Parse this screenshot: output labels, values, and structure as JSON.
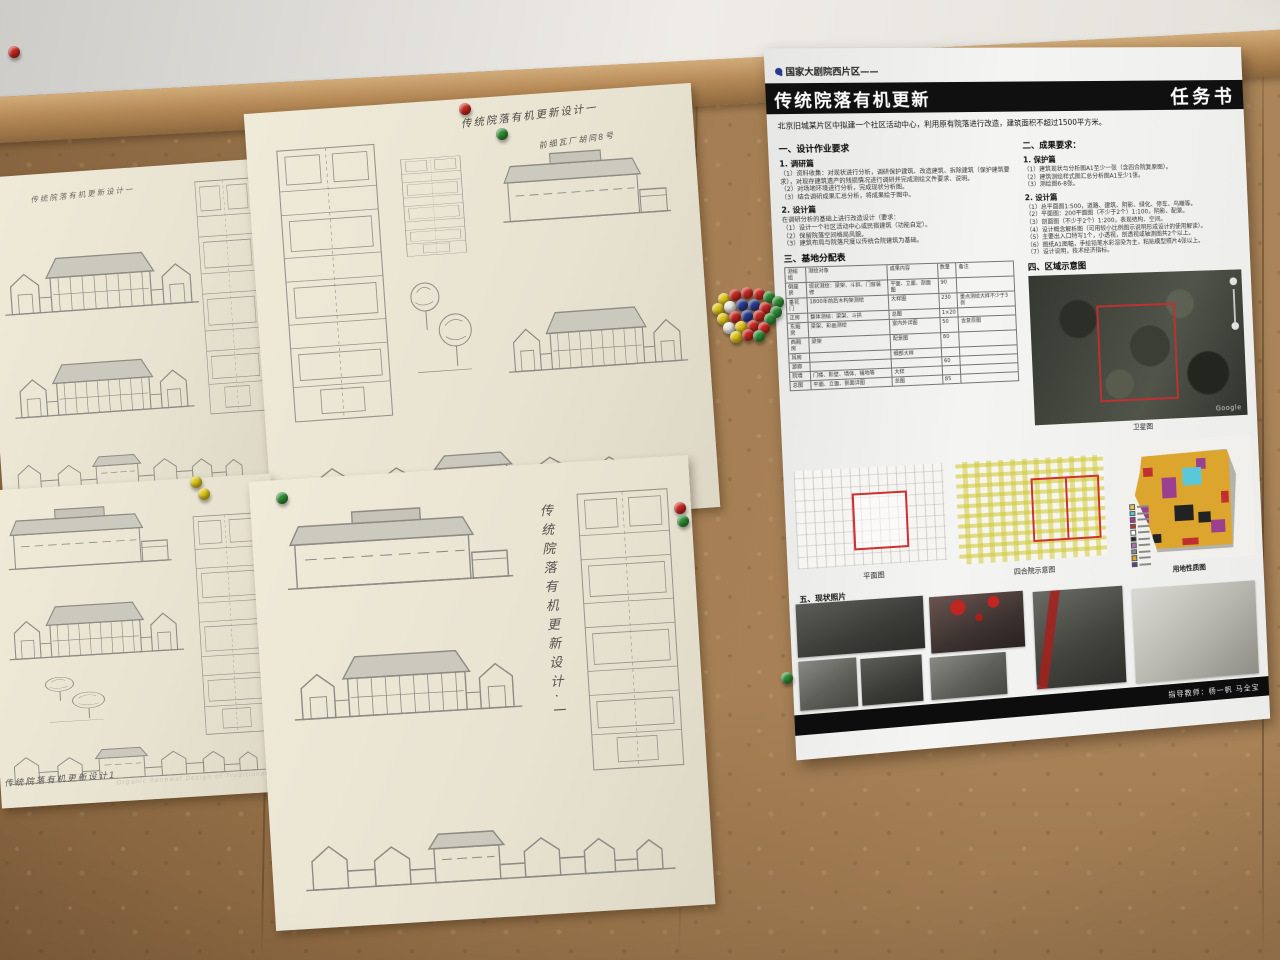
{
  "poster": {
    "corner_tag": "任务书",
    "project_tag": "国家大剧院西片区——",
    "title": "传统院落有机更新",
    "subtitle": "北京旧城某片区中拟建一个社区活动中心，利用原有院落进行改造，建筑面积不超过1500平方米。",
    "left_col": {
      "h1": "一、设计作业要求",
      "s1_h": "1. 调研篇",
      "s1_lines": [
        "（1）资料收集：对现状进行分析，调研保护建筑、改造建筑、拆除建筑（保护建筑要求），对现存建筑遗产的残损情况进行调研并完成测绘文件要求、说明。",
        "（2）对场地环境进行分析，完成现状分析图。",
        "（3）结合调研成果汇总分析，将成果绘于图中。"
      ],
      "s2_h": "2. 设计篇",
      "s2_lines": [
        "在调研分析的基础上进行改造设计（要求：",
        "（1）设计一个社区活动中心或民宿建筑（功能自定）。",
        "（2）保留院落空间格局风貌。",
        "（3）建筑布局与院落尺度以传统合院建筑为基础。"
      ],
      "h3": "三、基地分配表"
    },
    "table": {
      "headers": [
        "测绘组",
        "测绘对象",
        "成果内容",
        "数量",
        "备注"
      ],
      "rows": [
        [
          "倒座房",
          "现状测绘：梁架、斗拱、门窗装修",
          "平面、立面、剖面图",
          "90",
          ""
        ],
        [
          "垂花门",
          "1800年前后木构架测绘",
          "大样图",
          "230",
          "重点测绘大样不少于3张"
        ],
        [
          "正房",
          "整体测绘：梁架、斗拱",
          "总图",
          "1×20",
          ""
        ],
        [
          "东厢房",
          "梁架、彩画测绘",
          "室内外详图",
          "50",
          "含复原图"
        ],
        [
          "西厢房",
          "梁架",
          "配景图",
          "80",
          ""
        ],
        [
          "耳房",
          "",
          "细部大样",
          "",
          ""
        ],
        [
          "游廊",
          "",
          "",
          "60",
          ""
        ],
        [
          "院墙",
          "门楼、影壁、墙体、铺地等",
          "大样",
          "",
          ""
        ],
        [
          "总图",
          "平面、立面、剖面详图",
          "总图",
          "85",
          ""
        ]
      ]
    },
    "right_col": {
      "h2": "二、成果要求：",
      "p1_h": "1. 保护篇",
      "p1_lines": [
        "（1）建筑现状与分析图A1至少一张（含四合院复原图）。",
        "（2）建筑测绘样式图汇总分析图A1至少1张。",
        "（3）测绘图6-8张。"
      ],
      "p2_h": "2. 设计篇",
      "p2_lines": [
        "（1）总平面图1:500，道路、建筑、阴影、绿化、停车、鸟瞰等。",
        "（2）平面图：200平面图（不少于2个）1:100，阴影、配景。",
        "（3）剖面图（不少于2个）1:200，表现结构、空间。",
        "（4）设计概念解析图（可用较小比例图示说明形成设计的使用解读）。",
        "（5）主要出入口特写1个，小透视，剖透视或轴测图共2个以上。",
        "（6）图纸A1图幅，手绘铅笔水彩渲染为主，粘贴模型照片4张以上。",
        "（7）设计说明，技术经济指标。"
      ],
      "h4": "四、区域示意图"
    },
    "satellite": {
      "caption": "卫星图",
      "watermark": "Google"
    },
    "maps": {
      "m1_caption": "平面图",
      "m2_caption": "四合院示意图",
      "m3_caption": "用地性质图"
    },
    "photos_heading": "五、现状照片",
    "footer": "指导教师：杨一帆  马全宝",
    "landuse_legend": [
      "#e2c84a",
      "#59c8d8",
      "#9b3f8f",
      "#c03030",
      "#ffffff",
      "#222222",
      "#b06fae",
      "#8a8a8a",
      "#d9a62e",
      "#5a3f8f"
    ]
  },
  "sheets": {
    "a": {
      "title": "传统院落有机更新设计一"
    },
    "b": {
      "title": "传统院落有机更新设计一",
      "subtitle": "前细瓦厂胡同8号"
    },
    "c": {
      "title": "传统院落有机更新设计1",
      "subtitle_en": "Organic Renewal Design of Traditional Courtyard"
    },
    "d": {
      "title_vertical": "传统院落有机更新设计·一"
    }
  },
  "drawings": {
    "a": [
      {
        "type": "court",
        "x": 12,
        "y": 62,
        "w": 200,
        "h": 85
      },
      {
        "type": "court",
        "x": 15,
        "y": 170,
        "w": 185,
        "h": 80
      },
      {
        "type": "street",
        "x": 10,
        "y": 268,
        "w": 240,
        "h": 55
      },
      {
        "type": "plan",
        "x": 210,
        "y": 15,
        "w": 62,
        "h": 240
      }
    ],
    "b": [
      {
        "type": "plan",
        "x": 25,
        "y": 35,
        "w": 108,
        "h": 280
      },
      {
        "type": "plan",
        "x": 150,
        "y": 55,
        "w": 66,
        "h": 100
      },
      {
        "type": "trees",
        "x": 148,
        "y": 170,
        "w": 70,
        "h": 120
      },
      {
        "type": "long",
        "x": 248,
        "y": 55,
        "w": 175,
        "h": 80
      },
      {
        "type": "court",
        "x": 244,
        "y": 195,
        "w": 185,
        "h": 90
      },
      {
        "type": "street",
        "x": 35,
        "y": 330,
        "w": 385,
        "h": 75
      }
    ],
    "c": [
      {
        "type": "long",
        "x": 18,
        "y": 18,
        "w": 170,
        "h": 70
      },
      {
        "type": "court",
        "x": 14,
        "y": 98,
        "w": 180,
        "h": 80
      },
      {
        "type": "trees",
        "x": 45,
        "y": 185,
        "w": 70,
        "h": 60
      },
      {
        "type": "plan",
        "x": 205,
        "y": 35,
        "w": 70,
        "h": 225
      },
      {
        "type": "street",
        "x": 8,
        "y": 248,
        "w": 260,
        "h": 52
      }
    ],
    "d": [
      {
        "type": "long",
        "x": 28,
        "y": 30,
        "w": 235,
        "h": 90
      },
      {
        "type": "court",
        "x": 28,
        "y": 155,
        "w": 235,
        "h": 95
      },
      {
        "type": "plan",
        "x": 322,
        "y": 28,
        "w": 100,
        "h": 285
      },
      {
        "type": "street",
        "x": 30,
        "y": 335,
        "w": 375,
        "h": 85
      }
    ]
  },
  "photos": [
    {
      "x": 6,
      "y": 542,
      "w": 124,
      "h": 52,
      "tone": "dark"
    },
    {
      "x": 6,
      "y": 598,
      "w": 56,
      "h": 48,
      "tone": "mid"
    },
    {
      "x": 66,
      "y": 600,
      "w": 60,
      "h": 46,
      "tone": "dark"
    },
    {
      "x": 136,
      "y": 544,
      "w": 94,
      "h": 56,
      "tone": "lantern"
    },
    {
      "x": 134,
      "y": 604,
      "w": 76,
      "h": 42,
      "tone": "mid"
    },
    {
      "x": 240,
      "y": 546,
      "w": 92,
      "h": 98,
      "tone": "redstreak"
    },
    {
      "x": 342,
      "y": 550,
      "w": 130,
      "h": 96,
      "tone": "light"
    }
  ],
  "pins": [
    {
      "x": 8,
      "y": 46,
      "color": "red"
    },
    {
      "x": 459,
      "y": 103,
      "color": "red"
    },
    {
      "x": 496,
      "y": 128,
      "color": "green"
    },
    {
      "x": 190,
      "y": 476,
      "color": "yellow"
    },
    {
      "x": 198,
      "y": 488,
      "color": "yellow"
    },
    {
      "x": 276,
      "y": 492,
      "color": "green"
    },
    {
      "x": 674,
      "y": 502,
      "color": "red"
    },
    {
      "x": 677,
      "y": 515,
      "color": "green"
    },
    {
      "x": 781,
      "y": 672,
      "color": "green"
    },
    {
      "x": 718,
      "y": 293,
      "color": "yellow"
    },
    {
      "x": 729,
      "y": 289,
      "color": "red"
    },
    {
      "x": 741,
      "y": 287,
      "color": "red"
    },
    {
      "x": 753,
      "y": 288,
      "color": "red"
    },
    {
      "x": 763,
      "y": 291,
      "color": "green"
    },
    {
      "x": 772,
      "y": 296,
      "color": "green"
    },
    {
      "x": 712,
      "y": 303,
      "color": "yellow"
    },
    {
      "x": 724,
      "y": 301,
      "color": "white"
    },
    {
      "x": 736,
      "y": 299,
      "color": "navy"
    },
    {
      "x": 748,
      "y": 299,
      "color": "navy"
    },
    {
      "x": 759,
      "y": 302,
      "color": "red"
    },
    {
      "x": 770,
      "y": 306,
      "color": "green"
    },
    {
      "x": 717,
      "y": 313,
      "color": "yellow"
    },
    {
      "x": 729,
      "y": 311,
      "color": "red"
    },
    {
      "x": 741,
      "y": 310,
      "color": "navy"
    },
    {
      "x": 753,
      "y": 310,
      "color": "red"
    },
    {
      "x": 764,
      "y": 313,
      "color": "green"
    },
    {
      "x": 723,
      "y": 322,
      "color": "white"
    },
    {
      "x": 735,
      "y": 321,
      "color": "yellow"
    },
    {
      "x": 747,
      "y": 320,
      "color": "red"
    },
    {
      "x": 758,
      "y": 322,
      "color": "red"
    },
    {
      "x": 730,
      "y": 331,
      "color": "yellow"
    },
    {
      "x": 742,
      "y": 329,
      "color": "red"
    },
    {
      "x": 753,
      "y": 330,
      "color": "green"
    }
  ]
}
